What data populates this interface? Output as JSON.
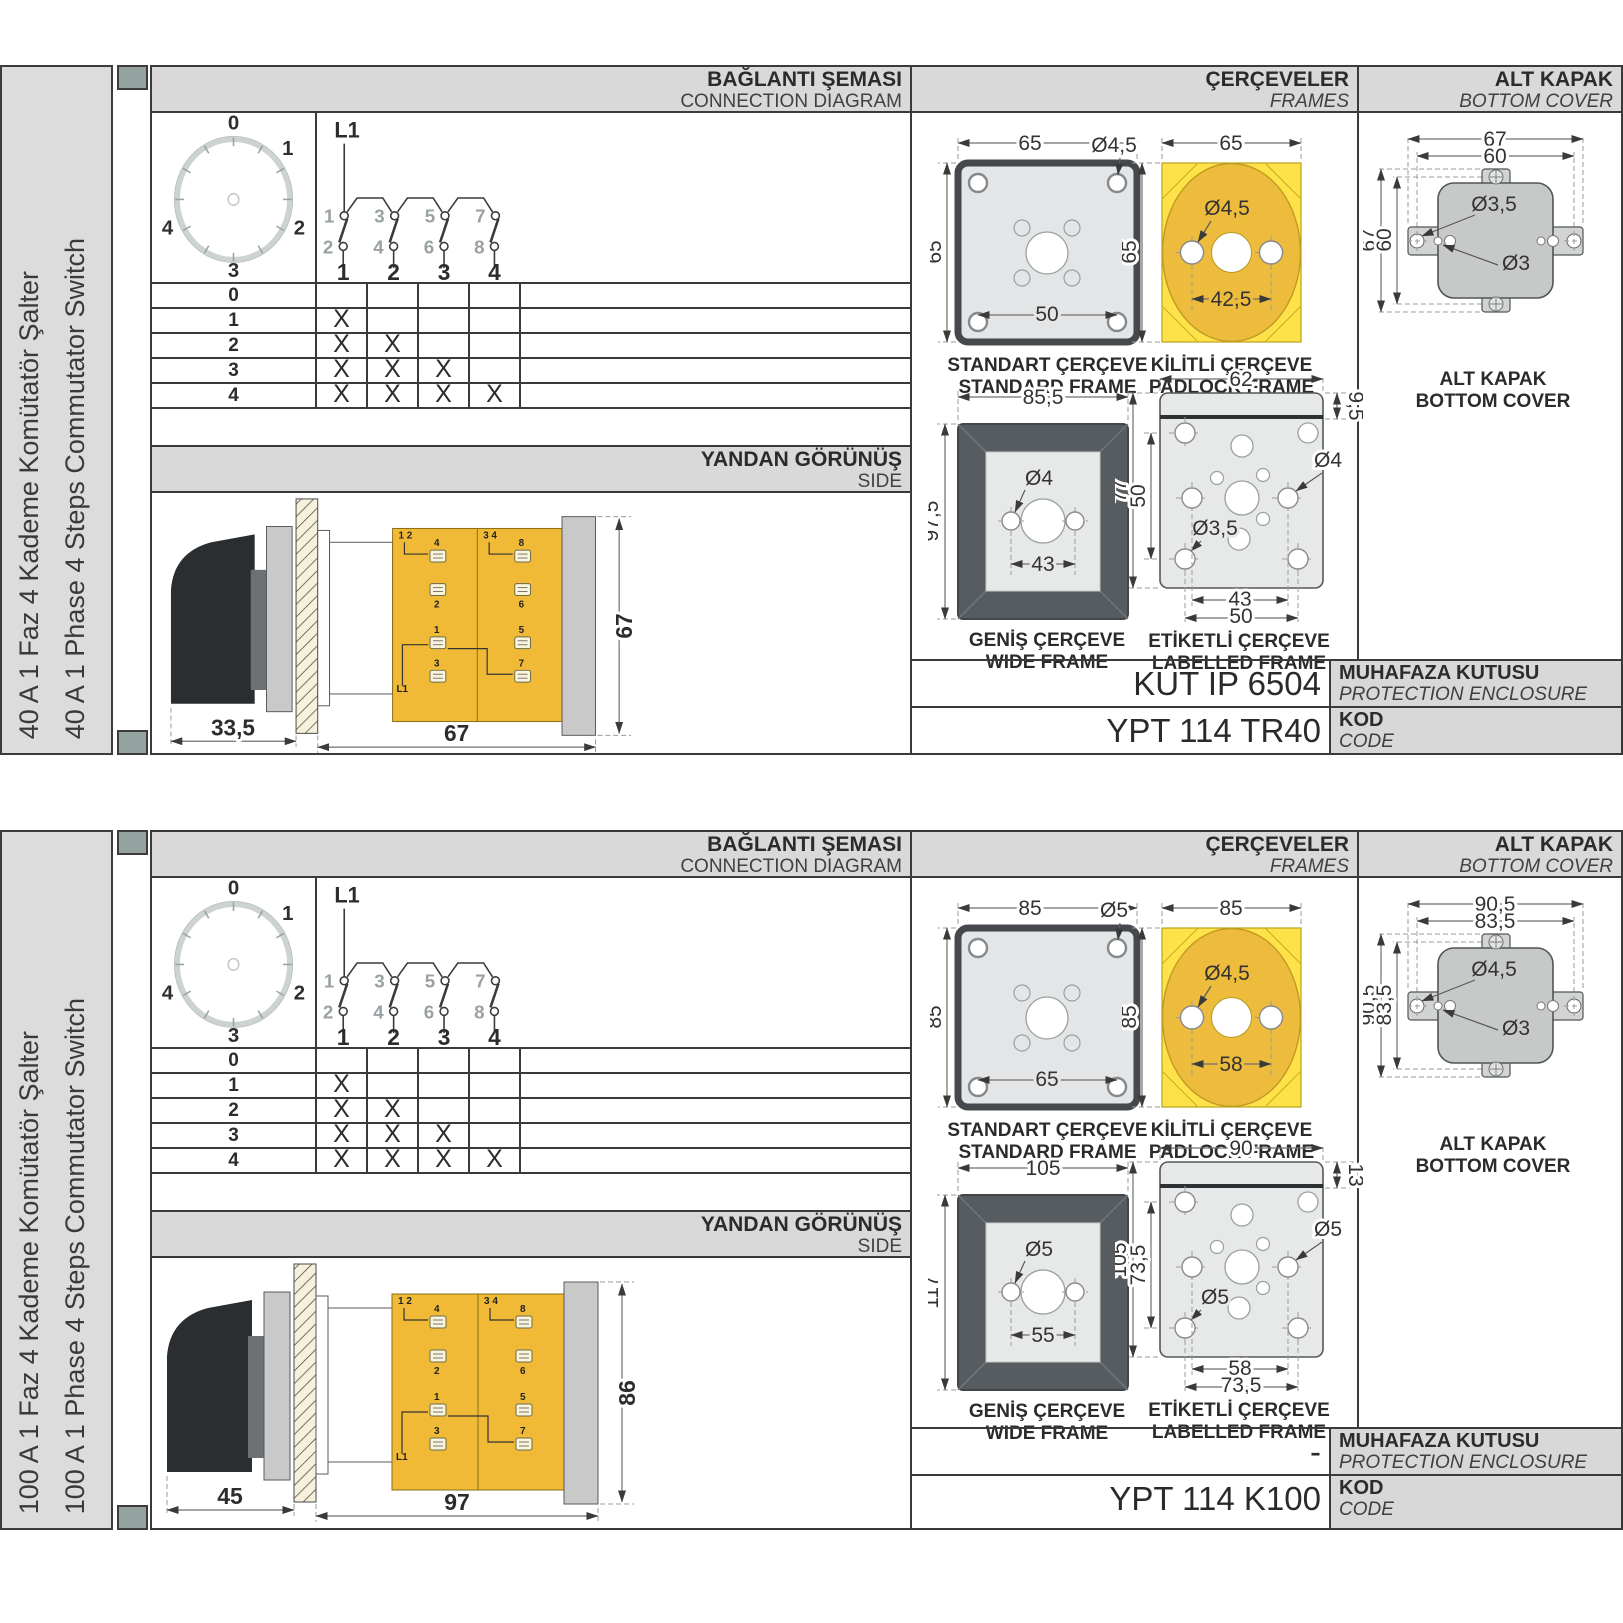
{
  "colors": {
    "header_gray": "#d9d9d9",
    "strip_gray": "#dcdcdc",
    "line_dark": "#3a3a3a",
    "frame_yellow": "#ffe14a",
    "frame_amber": "#eebc3d",
    "body_yellow": "#f1ba36",
    "wide_frame_dark": "#575c60",
    "plate_gray": "#c9c9c9",
    "cover_gray": "#c7c9c9",
    "marker_green_gray": "#95a3a0"
  },
  "sections": [
    {
      "side_labels": {
        "tr": "40 A 1 Faz 4 Kademe Komütatör Şalter",
        "en": "40 A 1 Phase 4 Steps Commutator Switch"
      },
      "conn": {
        "title_tr": "BAĞLANTI ŞEMASI",
        "title_en": "CONNECTION DIAGRAM",
        "l1": "L1",
        "dial": [
          "0",
          "1",
          "2",
          "3",
          "4"
        ],
        "top": [
          "1",
          "3",
          "5",
          "7"
        ],
        "bottom": [
          "2",
          "4",
          "6",
          "8"
        ],
        "out": [
          "1",
          "2",
          "3",
          "4"
        ]
      },
      "table": {
        "rows": [
          {
            "pos": "0",
            "marks": [
              "",
              "",
              "",
              ""
            ]
          },
          {
            "pos": "1",
            "marks": [
              "X",
              "",
              "",
              ""
            ]
          },
          {
            "pos": "2",
            "marks": [
              "X",
              "X",
              "",
              ""
            ]
          },
          {
            "pos": "3",
            "marks": [
              "X",
              "X",
              "X",
              ""
            ]
          },
          {
            "pos": "4",
            "marks": [
              "X",
              "X",
              "X",
              "X"
            ]
          }
        ]
      },
      "side": {
        "title_tr": "YANDAN GÖRÜNÜŞ",
        "title_en": "SIDE",
        "dims": {
          "handle": "33,5",
          "body": "67",
          "height": "67"
        },
        "t": {
          "pair1": "1 2",
          "pair2": "3 4",
          "t4": "4",
          "t8": "8",
          "t2": "2",
          "t6": "6",
          "t1": "1",
          "t5": "5",
          "t3": "3",
          "t7": "7",
          "l1": "L1"
        }
      },
      "frames": {
        "title_tr": "ÇERÇEVELER",
        "title_en": "FRAMES",
        "standard": {
          "cap_tr": "STANDART ÇERÇEVE",
          "cap_en": "STANDARD FRAME",
          "w": "65",
          "h": "65",
          "dia": "Ø4,5",
          "spacing": "50"
        },
        "padlock": {
          "cap_tr": "KİLİTLİ ÇERÇEVE",
          "cap_en": "PADLOCK FRAME",
          "w": "65",
          "h": "65",
          "dia": "Ø4,5",
          "spacing": "42,5"
        },
        "wide": {
          "cap_tr": "GENİŞ ÇERÇEVE",
          "cap_en": "WIDE FRAME",
          "w": "85,5",
          "h": "97,5",
          "dia": "Ø4",
          "spacing": "43"
        },
        "labelled": {
          "cap_tr": "ETİKETLİ ÇERÇEVE",
          "cap_en": "LABELLED FRAME",
          "w": "62",
          "label_h": "9,5",
          "h": "77",
          "inner_h": "50",
          "dia_right": "Ø4",
          "dia_bottom": "Ø3,5",
          "s_inner": "43",
          "s_outer": "50"
        }
      },
      "cover": {
        "title_tr": "ALT KAPAK",
        "title_en": "BOTTOM COVER",
        "cap_tr": "ALT KAPAK",
        "cap_en": "BOTTOM COVER",
        "outer_w": "67",
        "inner_w": "60",
        "outer_h": "67",
        "inner_h": "60",
        "dia1": "Ø3,5",
        "dia2": "Ø3"
      },
      "enclosure": {
        "value": "KUT IP 6504",
        "label_tr": "MUHAFAZA KUTUSU",
        "label_en": "PROTECTION ENCLOSURE"
      },
      "code": {
        "value": "YPT 114 TR40",
        "label_tr": "KOD",
        "label_en": "CODE"
      }
    },
    {
      "side_labels": {
        "tr": "100 A 1 Faz 4 Kademe Komütatör Şalter",
        "en": "100 A 1 Phase 4 Steps Commutator Switch"
      },
      "conn": {
        "title_tr": "BAĞLANTI ŞEMASI",
        "title_en": "CONNECTION DIAGRAM",
        "l1": "L1",
        "dial": [
          "0",
          "1",
          "2",
          "3",
          "4"
        ],
        "top": [
          "1",
          "3",
          "5",
          "7"
        ],
        "bottom": [
          "2",
          "4",
          "6",
          "8"
        ],
        "out": [
          "1",
          "2",
          "3",
          "4"
        ]
      },
      "table": {
        "rows": [
          {
            "pos": "0",
            "marks": [
              "",
              "",
              "",
              ""
            ]
          },
          {
            "pos": "1",
            "marks": [
              "X",
              "",
              "",
              ""
            ]
          },
          {
            "pos": "2",
            "marks": [
              "X",
              "X",
              "",
              ""
            ]
          },
          {
            "pos": "3",
            "marks": [
              "X",
              "X",
              "X",
              ""
            ]
          },
          {
            "pos": "4",
            "marks": [
              "X",
              "X",
              "X",
              "X"
            ]
          }
        ]
      },
      "side": {
        "title_tr": "YANDAN GÖRÜNÜŞ",
        "title_en": "SIDE",
        "dims": {
          "handle": "45",
          "body": "97",
          "height": "86"
        },
        "t": {
          "pair1": "1 2",
          "pair2": "3 4",
          "t4": "4",
          "t8": "8",
          "t2": "2",
          "t6": "6",
          "t1": "1",
          "t5": "5",
          "t3": "3",
          "t7": "7",
          "l1": "L1"
        }
      },
      "frames": {
        "title_tr": "ÇERÇEVELER",
        "title_en": "FRAMES",
        "standard": {
          "cap_tr": "STANDART ÇERÇEVE",
          "cap_en": "STANDARD FRAME",
          "w": "85",
          "h": "85",
          "dia": "Ø5",
          "spacing": "65"
        },
        "padlock": {
          "cap_tr": "KİLİTLİ ÇERÇEVE",
          "cap_en": "PADLOCK FRAME",
          "w": "85",
          "h": "85",
          "dia": "Ø4,5",
          "spacing": "58"
        },
        "wide": {
          "cap_tr": "GENİŞ ÇERÇEVE",
          "cap_en": "WIDE FRAME",
          "w": "105",
          "h": "117",
          "dia": "Ø5",
          "spacing": "55"
        },
        "labelled": {
          "cap_tr": "ETİKETLİ ÇERÇEVE",
          "cap_en": "LABELLED FRAME",
          "w": "90",
          "label_h": "13",
          "h": "105",
          "inner_h": "73,5",
          "dia_right": "Ø5",
          "dia_bottom": "Ø5",
          "s_inner": "58",
          "s_outer": "73,5"
        }
      },
      "cover": {
        "title_tr": "ALT KAPAK",
        "title_en": "BOTTOM COVER",
        "cap_tr": "ALT KAPAK",
        "cap_en": "BOTTOM COVER",
        "outer_w": "90,5",
        "inner_w": "83,5",
        "outer_h": "90,5",
        "inner_h": "83,5",
        "dia1": "Ø4,5",
        "dia2": "Ø3"
      },
      "enclosure": {
        "value": "-",
        "label_tr": "MUHAFAZA KUTUSU",
        "label_en": "PROTECTION ENCLOSURE"
      },
      "code": {
        "value": "YPT 114 K100",
        "label_tr": "KOD",
        "label_en": "CODE"
      }
    }
  ]
}
